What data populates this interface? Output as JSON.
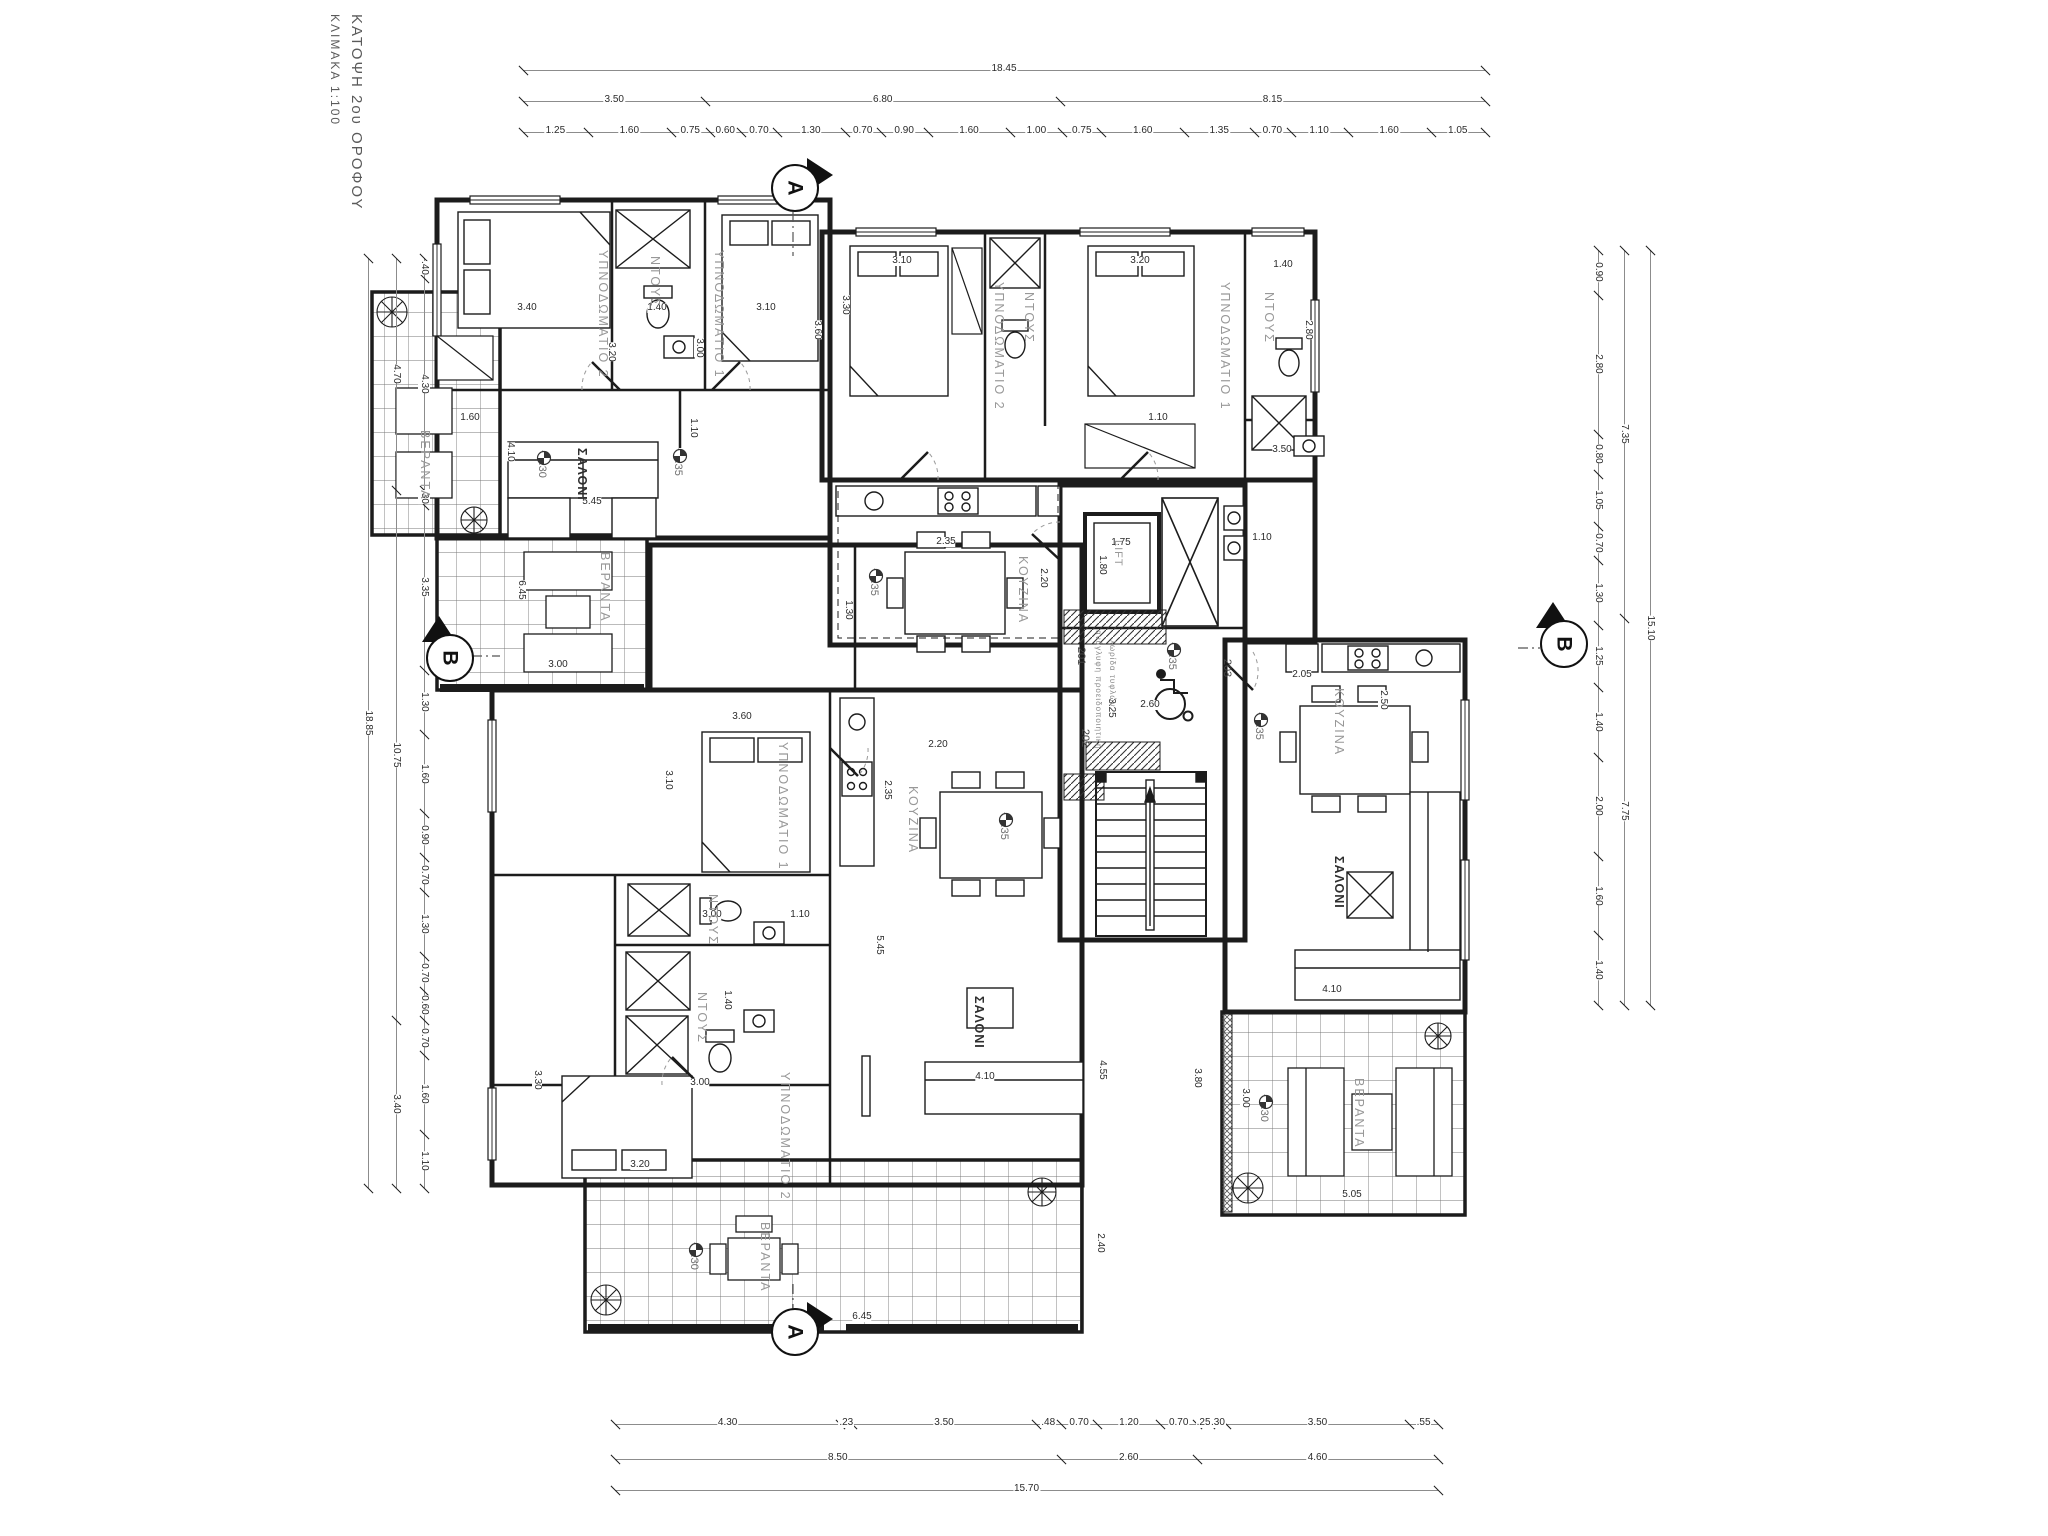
{
  "title": {
    "line1": "ΚΑΤΟΨΗ 2ου ΟΡΟΦΟΥ",
    "line2": "ΚΛΙΜΑΚΑ 1:100"
  },
  "colors": {
    "ink": "#1c1c1c",
    "gray_label": "#989898",
    "dim_line": "#8c8c8c",
    "paper": "#ffffff"
  },
  "section_markers": [
    {
      "t": "A",
      "x": 793,
      "y": 186,
      "tri": "right"
    },
    {
      "t": "A",
      "x": 793,
      "y": 1330,
      "tri": "right"
    },
    {
      "t": "B",
      "x": 448,
      "y": 656,
      "tri": "up"
    },
    {
      "t": "B",
      "x": 1562,
      "y": 642,
      "tri": "up"
    }
  ],
  "lift_label": "LIFT",
  "apartment_numbers": [
    {
      "t": "201",
      "x": 1072,
      "y": 650
    },
    {
      "t": "202",
      "x": 1076,
      "y": 732
    },
    {
      "t": "203",
      "x": 1218,
      "y": 662
    }
  ],
  "note": {
    "l1": "ανάγλυφη προειδοποιητική",
    "l2": "λωρίδα τυφλών",
    "x": 1094,
    "y": 630
  },
  "rooms": [
    {
      "t": "ΥΠΝΟΔΩΜΑΤΙΟ 2",
      "x": 596,
      "y": 250
    },
    {
      "t": "ΝΤΟΥΣ",
      "x": 648,
      "y": 256
    },
    {
      "t": "ΥΠΝΟΔΩΜΑΤΙΟ 1",
      "x": 712,
      "y": 250
    },
    {
      "t": "ΣΑΛΟΝΙ",
      "x": 575,
      "y": 448,
      "b": 1
    },
    {
      "t": "ΚΟΥΖΙΝΑ",
      "x": 1016,
      "y": 556
    },
    {
      "t": "ΥΠΝΟΔΩΜΑΤΙΟ 2",
      "x": 992,
      "y": 282
    },
    {
      "t": "ΝΤΟΥΣ",
      "x": 1022,
      "y": 292
    },
    {
      "t": "ΥΠΝΟΔΩΜΑΤΙΟ 1",
      "x": 1218,
      "y": 282
    },
    {
      "t": "ΝΤΟΥΣ",
      "x": 1262,
      "y": 292
    },
    {
      "t": "ΚΟΥΖΙΝΑ",
      "x": 1332,
      "y": 688
    },
    {
      "t": "ΣΑΛΟΝΙ",
      "x": 1332,
      "y": 856,
      "b": 1
    },
    {
      "t": "ΥΠΝΟΔΩΜΑΤΙΟ 1",
      "x": 776,
      "y": 742
    },
    {
      "t": "ΝΤΟΥΣ",
      "x": 706,
      "y": 894
    },
    {
      "t": "ΝΤΟΥΣ",
      "x": 695,
      "y": 992
    },
    {
      "t": "ΥΠΝΟΔΩΜΑΤΙΟ 2",
      "x": 778,
      "y": 1072
    },
    {
      "t": "ΚΟΥΖΙΝΑ",
      "x": 906,
      "y": 786
    },
    {
      "t": "ΣΑΛΟΝΙ",
      "x": 972,
      "y": 996,
      "b": 1
    },
    {
      "t": "ΒΕΡΑΝΤΑ",
      "x": 598,
      "y": 552
    },
    {
      "t": "ΒΕΡΑΝΤΑ",
      "x": 758,
      "y": 1222
    },
    {
      "t": "ΒΕΡΑΝΤΑ",
      "x": 1352,
      "y": 1078
    },
    {
      "t": "ΒΕΡΑΝΤΑ",
      "x": 418,
      "y": 430
    }
  ],
  "levels": [
    {
      "t": "+6.35",
      "x": 672,
      "y": 448
    },
    {
      "t": "+6.35",
      "x": 868,
      "y": 568
    },
    {
      "t": "+6.35",
      "x": 1166,
      "y": 642
    },
    {
      "t": "+6.35",
      "x": 1253,
      "y": 712
    },
    {
      "t": "+6.35",
      "x": 998,
      "y": 812
    },
    {
      "t": "+6.30",
      "x": 536,
      "y": 450
    },
    {
      "t": "+6.30",
      "x": 688,
      "y": 1242
    },
    {
      "t": "+6.30",
      "x": 1258,
      "y": 1094
    }
  ],
  "dim_chains": [
    {
      "id": "top-overall",
      "o": "h",
      "x": 523,
      "y": 70,
      "len": 962,
      "vals": [
        "18.45"
      ]
    },
    {
      "id": "top-mid",
      "o": "h",
      "x": 523,
      "y": 101,
      "len": 962,
      "vals": [
        "3.50",
        "6.80",
        "8.15"
      ]
    },
    {
      "id": "top-detail",
      "o": "h",
      "x": 523,
      "y": 132,
      "len": 962,
      "vals": [
        "1.25",
        "1.60",
        "0.75",
        "0.60",
        "0.70",
        "1.30",
        "0.70",
        "0.90",
        "1.60",
        "1.00",
        "0.75",
        "1.60",
        "1.35",
        "0.70",
        "1.10",
        "1.60",
        "1.05"
      ]
    },
    {
      "id": "left-overall",
      "o": "v",
      "x": 368,
      "y": 258,
      "len": 930,
      "vals": [
        "18.85"
      ]
    },
    {
      "id": "left-mid",
      "o": "v",
      "x": 396,
      "y": 258,
      "len": 930,
      "vals": [
        "4.70",
        "10.75",
        "3.40"
      ]
    },
    {
      "id": "left-detail",
      "o": "v",
      "x": 424,
      "y": 258,
      "len": 930,
      "vals": [
        ".40",
        "4.30",
        ".30",
        "3.35",
        "1.30",
        "1.60",
        "0.90",
        "0.70",
        "1.30",
        "0.70",
        "0.60",
        "0.70",
        "1.60",
        "1.10"
      ]
    },
    {
      "id": "right-overall",
      "o": "v",
      "x": 1650,
      "y": 250,
      "len": 755,
      "vals": [
        "15.10"
      ]
    },
    {
      "id": "right-mid",
      "o": "v",
      "x": 1624,
      "y": 250,
      "len": 755,
      "vals": [
        "7.35",
        "7.75"
      ]
    },
    {
      "id": "right-detail",
      "o": "v",
      "x": 1598,
      "y": 250,
      "len": 755,
      "vals": [
        "0.90",
        "2.80",
        "0.80",
        "1.05",
        "0.70",
        "1.30",
        "1.25",
        "1.40",
        "2.00",
        "1.60",
        "1.40"
      ]
    },
    {
      "id": "bottom-detail",
      "o": "h",
      "x": 615,
      "y": 1424,
      "len": 823,
      "vals": [
        "4.30",
        ".23",
        "3.50",
        ".48",
        "0.70",
        "1.20",
        "0.70",
        ".25",
        ".30",
        "3.50",
        ".55"
      ]
    },
    {
      "id": "bottom-mid",
      "o": "h",
      "x": 615,
      "y": 1459,
      "len": 823,
      "vals": [
        "8.50",
        "2.60",
        "4.60"
      ]
    },
    {
      "id": "bottom-overall",
      "o": "h",
      "x": 615,
      "y": 1490,
      "len": 823,
      "vals": [
        "15.70"
      ]
    }
  ],
  "interior_dims": [
    {
      "t": "3.40",
      "x": 527,
      "y": 303,
      "o": "h"
    },
    {
      "t": "3.20",
      "x": 606,
      "y": 352,
      "o": "v"
    },
    {
      "t": "1.40",
      "x": 657,
      "y": 303,
      "o": "h"
    },
    {
      "t": "3.00",
      "x": 694,
      "y": 348,
      "o": "v"
    },
    {
      "t": "3.10",
      "x": 766,
      "y": 303,
      "o": "h"
    },
    {
      "t": "3.60",
      "x": 812,
      "y": 330,
      "o": "v"
    },
    {
      "t": "1.10",
      "x": 688,
      "y": 428,
      "o": "v"
    },
    {
      "t": "5.45",
      "x": 592,
      "y": 497,
      "o": "h"
    },
    {
      "t": "4.10",
      "x": 505,
      "y": 452,
      "o": "v"
    },
    {
      "t": "2.35",
      "x": 946,
      "y": 537,
      "o": "h"
    },
    {
      "t": "2.20",
      "x": 1038,
      "y": 578,
      "o": "v"
    },
    {
      "t": "1.30",
      "x": 843,
      "y": 610,
      "o": "v"
    },
    {
      "t": "3.10",
      "x": 902,
      "y": 256,
      "o": "h"
    },
    {
      "t": "3.30",
      "x": 840,
      "y": 305,
      "o": "v"
    },
    {
      "t": "3.20",
      "x": 1140,
      "y": 256,
      "o": "h"
    },
    {
      "t": "1.40",
      "x": 1283,
      "y": 260,
      "o": "h"
    },
    {
      "t": "2.80",
      "x": 1303,
      "y": 330,
      "o": "v"
    },
    {
      "t": "3.50",
      "x": 1282,
      "y": 445,
      "o": "h"
    },
    {
      "t": "1.10",
      "x": 1158,
      "y": 413,
      "o": "h"
    },
    {
      "t": "1.75",
      "x": 1121,
      "y": 538,
      "o": "h"
    },
    {
      "t": "1.80",
      "x": 1097,
      "y": 565,
      "o": "v"
    },
    {
      "t": "3.25",
      "x": 1106,
      "y": 708,
      "o": "v"
    },
    {
      "t": "1.10",
      "x": 1262,
      "y": 533,
      "o": "h"
    },
    {
      "t": "2.60",
      "x": 1150,
      "y": 700,
      "o": "h"
    },
    {
      "t": "3.60",
      "x": 742,
      "y": 712,
      "o": "h"
    },
    {
      "t": "3.10",
      "x": 663,
      "y": 780,
      "o": "v"
    },
    {
      "t": "3.00",
      "x": 712,
      "y": 910,
      "o": "h"
    },
    {
      "t": "1.10",
      "x": 800,
      "y": 910,
      "o": "h"
    },
    {
      "t": "1.40",
      "x": 722,
      "y": 1000,
      "o": "v"
    },
    {
      "t": "3.00",
      "x": 700,
      "y": 1078,
      "o": "h"
    },
    {
      "t": "3.30",
      "x": 532,
      "y": 1080,
      "o": "v"
    },
    {
      "t": "3.20",
      "x": 640,
      "y": 1160,
      "o": "h"
    },
    {
      "t": "2.20",
      "x": 938,
      "y": 740,
      "o": "h"
    },
    {
      "t": "2.35",
      "x": 882,
      "y": 790,
      "o": "v"
    },
    {
      "t": "5.45",
      "x": 874,
      "y": 945,
      "o": "v"
    },
    {
      "t": "4.10",
      "x": 985,
      "y": 1072,
      "o": "h"
    },
    {
      "t": "4.55",
      "x": 1097,
      "y": 1070,
      "o": "v"
    },
    {
      "t": "2.40",
      "x": 1095,
      "y": 1243,
      "o": "v"
    },
    {
      "t": "6.45",
      "x": 862,
      "y": 1312,
      "o": "h"
    },
    {
      "t": "6.45",
      "x": 516,
      "y": 590,
      "o": "v"
    },
    {
      "t": "1.60",
      "x": 470,
      "y": 413,
      "o": "h"
    },
    {
      "t": "3.00",
      "x": 558,
      "y": 660,
      "o": "h"
    },
    {
      "t": "2.05",
      "x": 1302,
      "y": 670,
      "o": "h"
    },
    {
      "t": "2.50",
      "x": 1378,
      "y": 700,
      "o": "v"
    },
    {
      "t": "4.10",
      "x": 1332,
      "y": 985,
      "o": "h"
    },
    {
      "t": "5.05",
      "x": 1352,
      "y": 1190,
      "o": "h"
    },
    {
      "t": "3.00",
      "x": 1240,
      "y": 1098,
      "o": "v"
    },
    {
      "t": "3.80",
      "x": 1192,
      "y": 1078,
      "o": "v"
    }
  ]
}
